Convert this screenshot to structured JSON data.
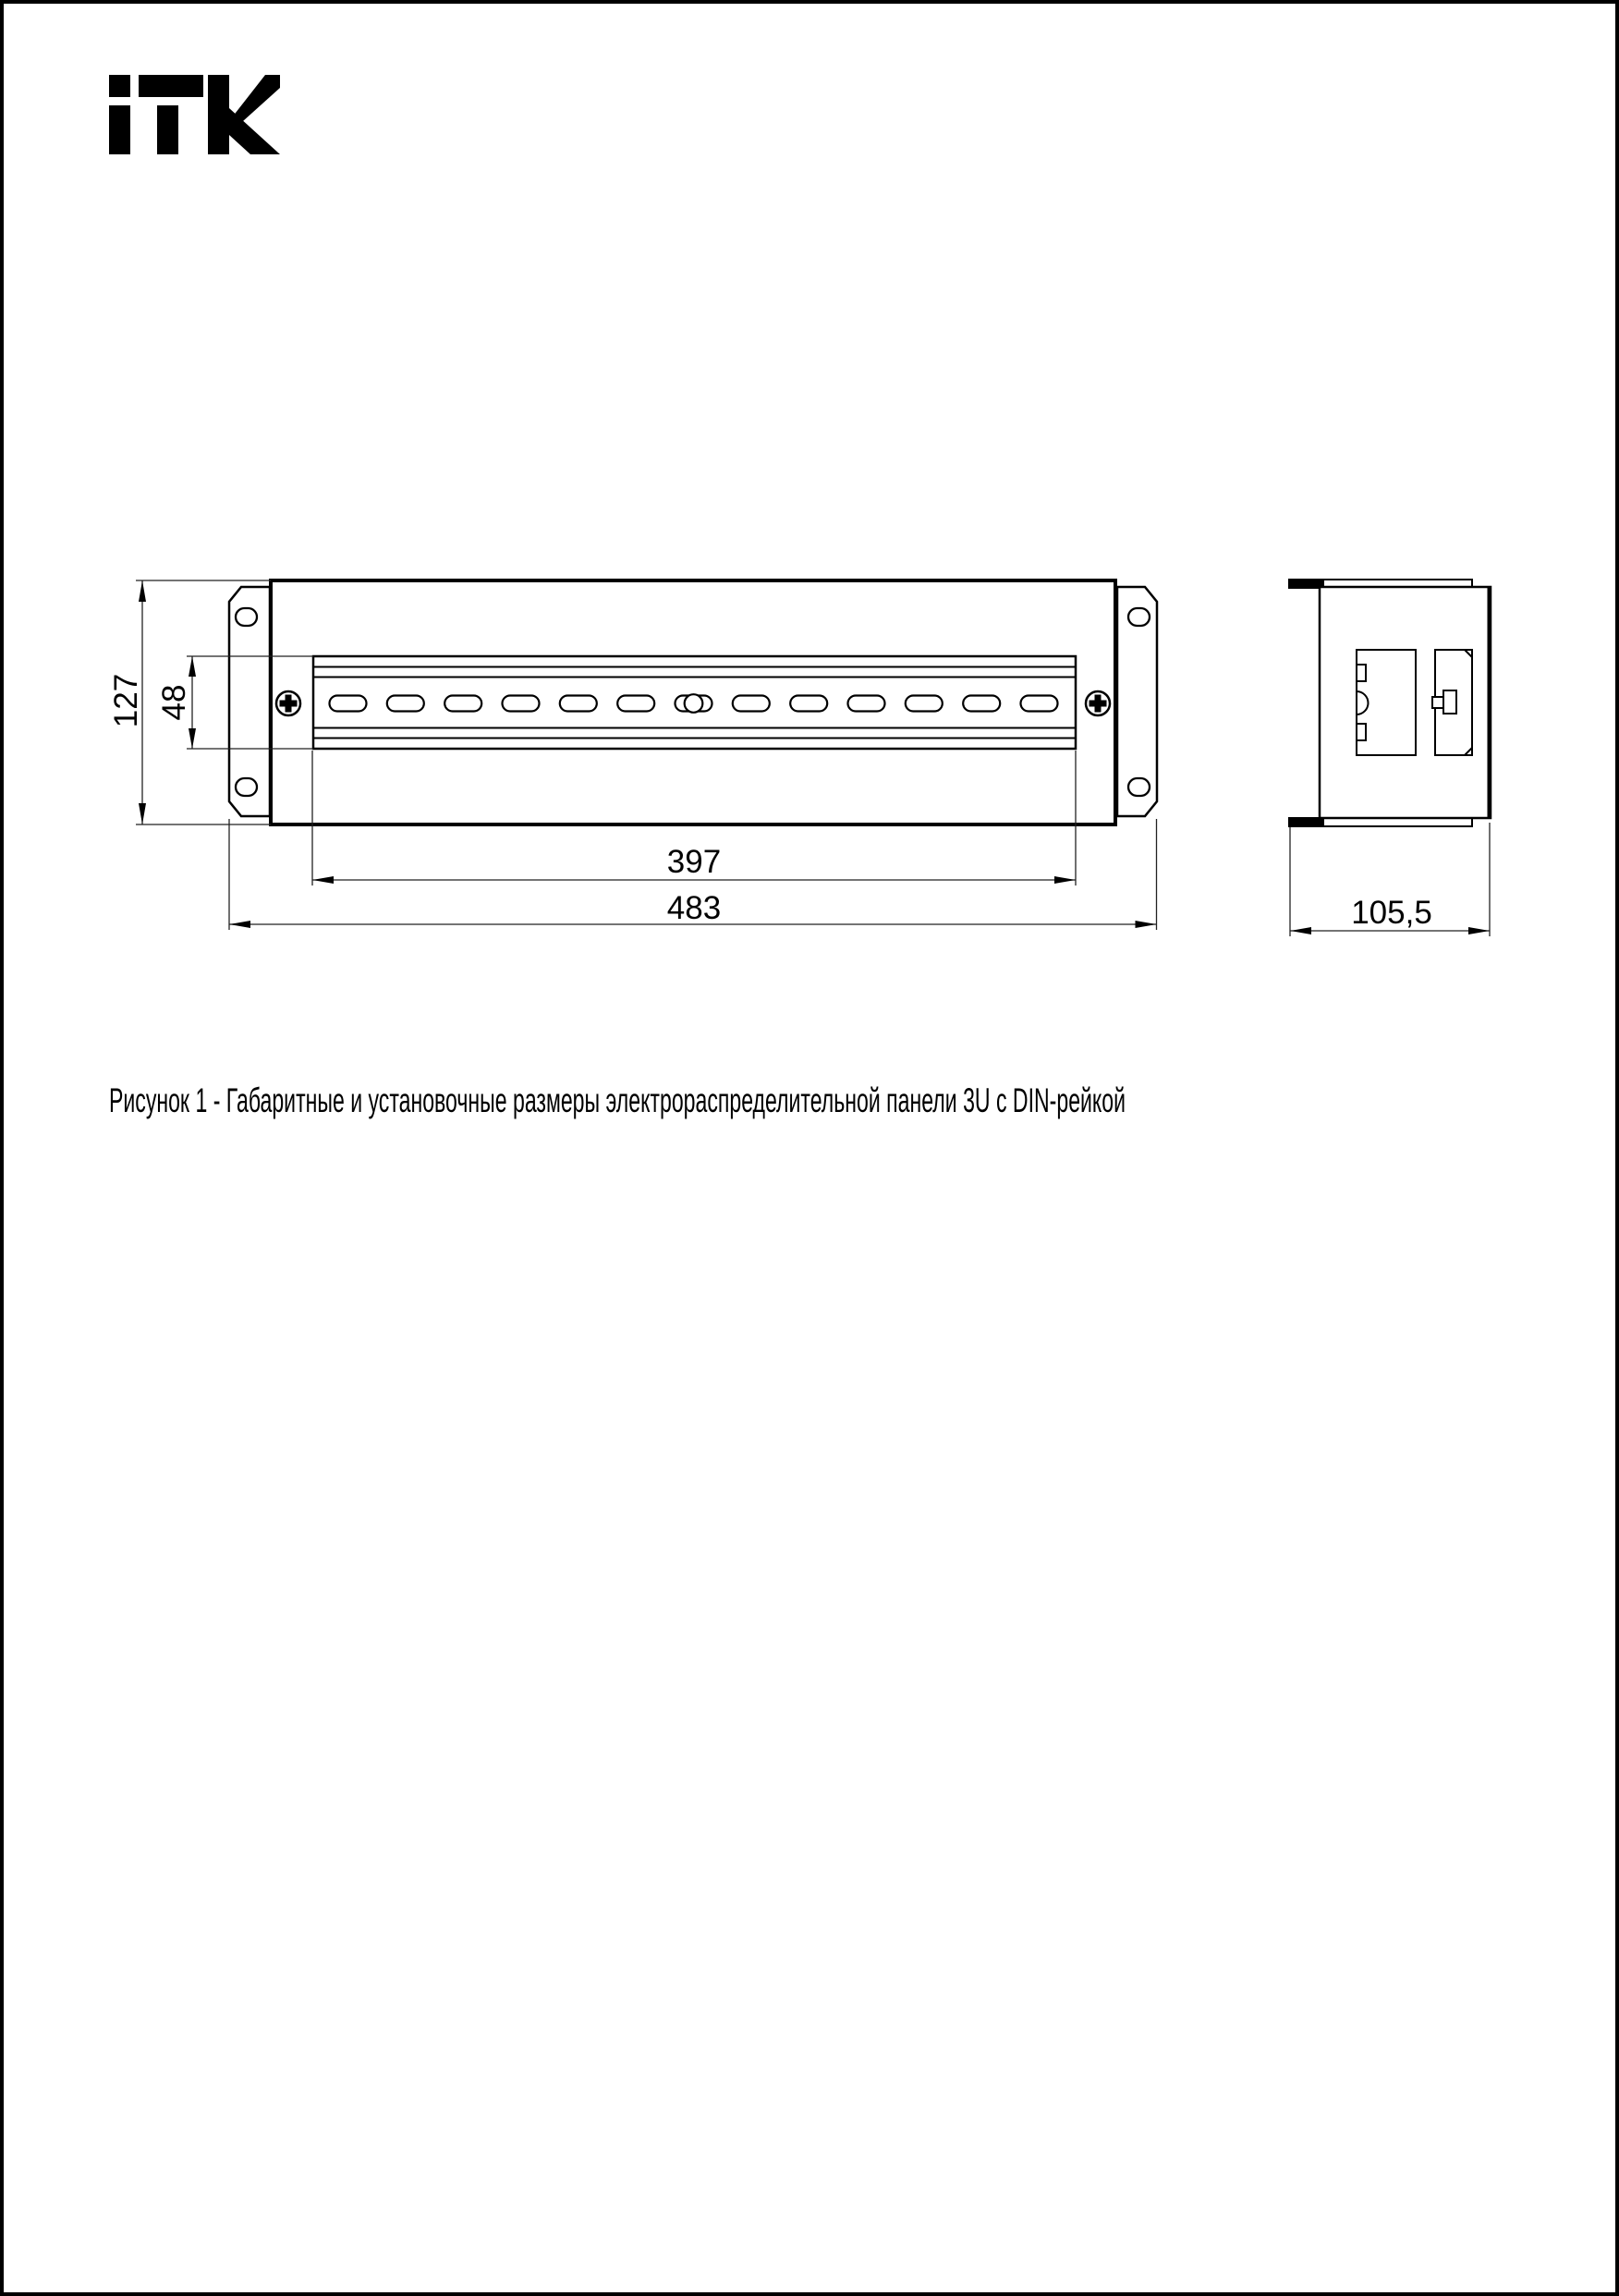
{
  "page": {
    "background": "#ffffff",
    "border_color": "#000000",
    "line_color": "#1a1a1a",
    "caption": "Рисунок 1 - Габаритные и установочные размеры электрораспределительной панели 3U с DIN-рейкой"
  },
  "logo": {
    "brand": "ITK"
  },
  "drawing": {
    "front_view": {
      "height_label": "127",
      "din_zone_height_label": "48",
      "din_rail_length_label": "397",
      "panel_width_label": "483"
    },
    "side_view": {
      "depth_label": "105,5"
    }
  }
}
